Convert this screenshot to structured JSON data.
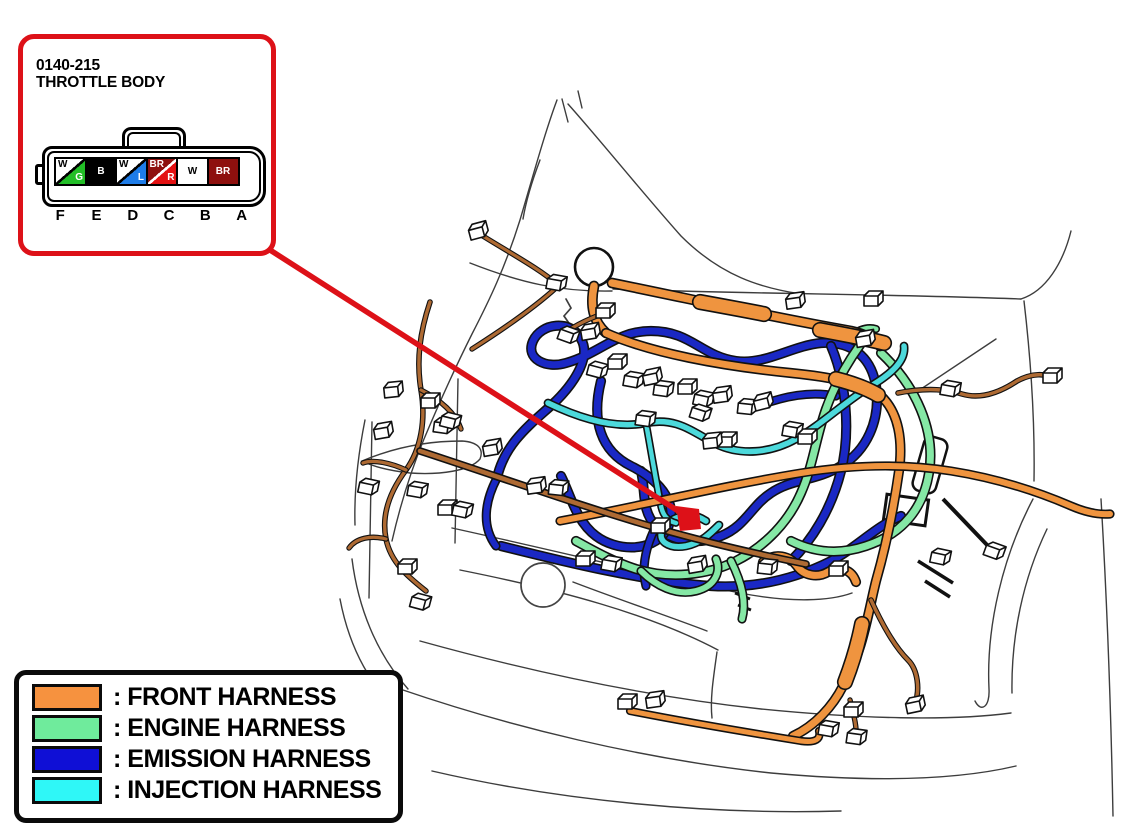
{
  "figure": {
    "type": "wiring harness location diagram",
    "view": "vehicle front engine compartment"
  },
  "callout": {
    "code": "0140-215",
    "name": "THROTTLE BODY",
    "border_color": "#DD1118",
    "connector": {
      "lock_icon": "bowtie",
      "pin_ids": [
        "F",
        "E",
        "D",
        "C",
        "B",
        "A"
      ],
      "pins": [
        {
          "id": "F",
          "split": true,
          "upper_text": "W",
          "upper_bg": "#FFFFFF",
          "upper_fg": "#000000",
          "lower_text": "G",
          "lower_bg": "#22BE27",
          "lower_fg": "#FFFFFF",
          "divider": "#000000"
        },
        {
          "id": "E",
          "split": false,
          "text": "B",
          "bg": "#000000",
          "fg": "#FFFFFF"
        },
        {
          "id": "D",
          "split": true,
          "upper_text": "W",
          "upper_bg": "#FFFFFF",
          "upper_fg": "#000000",
          "lower_text": "L",
          "lower_bg": "#1E7CE8",
          "lower_fg": "#FFFFFF",
          "divider": "#000000"
        },
        {
          "id": "C",
          "split": true,
          "upper_text": "BR",
          "upper_bg": "#8E100E",
          "upper_fg": "#FFFFFF",
          "lower_text": "R",
          "lower_bg": "#E31112",
          "lower_fg": "#FFFFFF",
          "divider": "#FFFFFF"
        },
        {
          "id": "B",
          "split": false,
          "text": "W",
          "bg": "#FFFFFF",
          "fg": "#000000"
        },
        {
          "id": "A",
          "split": false,
          "text": "BR",
          "bg": "#8E100E",
          "fg": "#FFFFFF"
        }
      ]
    }
  },
  "leader": {
    "color": "#DD1118"
  },
  "legend": {
    "items": [
      {
        "key": "front",
        "label": ": FRONT HARNESS",
        "color": "#F6923F"
      },
      {
        "key": "engine",
        "label": ": ENGINE HARNESS",
        "color": "#6FEB9C"
      },
      {
        "key": "emission",
        "label": ": EMISSION HARNESS",
        "color": "#0F0FD6"
      },
      {
        "key": "injection",
        "label": ": INJECTION HARNESS",
        "color": "#2FF7F7"
      }
    ]
  },
  "harness_colors": {
    "front": "#EF943F",
    "engine": "#85E8A5",
    "emission": "#1A28C4",
    "injection": "#4CD9DB",
    "branch_wire": "#AE6A33",
    "outline": "#111111"
  }
}
